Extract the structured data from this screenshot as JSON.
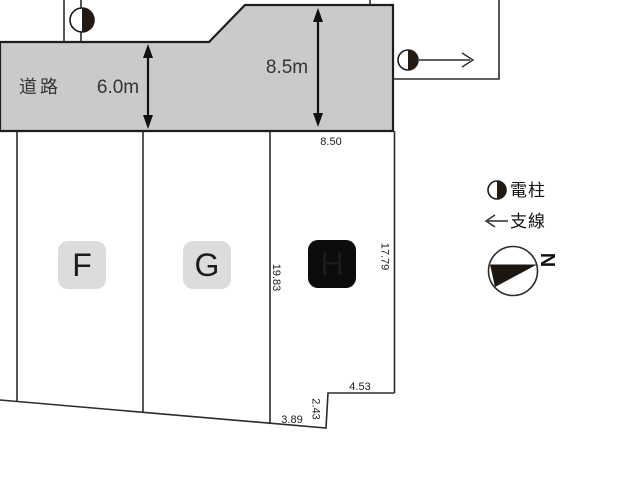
{
  "plan": {
    "road": {
      "label": "道路",
      "width_dim": "6.0m",
      "depth_dim": "8.5m"
    },
    "lots": {
      "f_label": "F",
      "g_label": "G",
      "h_label": "H"
    },
    "dims": {
      "top": "8.50",
      "left": "19.83",
      "right": "17.79",
      "step_top": "4.53",
      "step_side": "2.43",
      "bottom": "3.89"
    },
    "legend": {
      "pole_label": "電柱",
      "wire_label": "支線",
      "north_letter": "N"
    },
    "colors": {
      "road_fill": "#cacaca",
      "line": "#2b2b2b",
      "badge_light": "#dcdcdc",
      "badge_dark": "#0c0c0c",
      "badge_text": "#ffffff"
    }
  }
}
